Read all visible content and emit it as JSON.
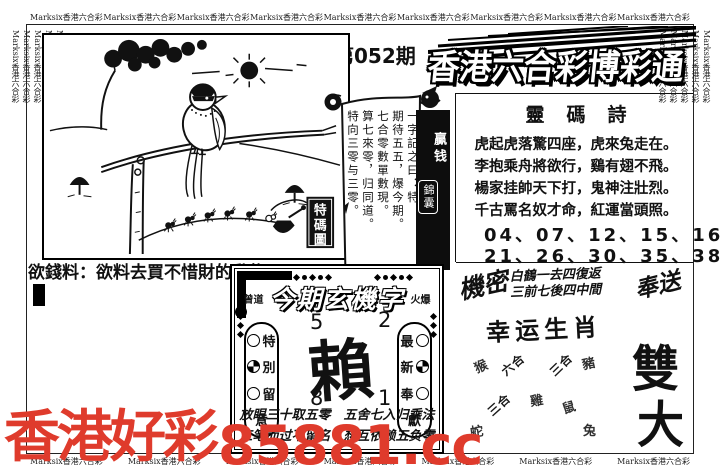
{
  "border": {
    "marquee_text": "Marksix香港六合彩"
  },
  "masthead": {
    "issue": "第052期",
    "title": "香港六合彩博彩通"
  },
  "cartoon": {
    "stamp_chars": [
      "特",
      "碼",
      "圖"
    ]
  },
  "hint": {
    "label": "欲錢料：",
    "text": "欲料去買不惜財的動物"
  },
  "scroll": {
    "text": "一字記之曰：特\n期待五五，爆今期。\n七合零數單數現。\n算七來零，归同道。\n特向三零与三零。",
    "signature": "■金小姐"
  },
  "banner": {
    "line1": "贏钱",
    "line2": "錦囊"
  },
  "poem": {
    "title": "靈碼詩",
    "lines": [
      "虎起虎落驚四座，虎來兔走在。",
      "李抱乘舟將欲行，鷄有翅不飛。",
      "楊家挂帥天下打，鬼神注壯烈。",
      "千古罵名奴才命，紅運當頭照。"
    ],
    "numbers1": "04、07、12、15、16",
    "numbers2": "21、26、30、35、38"
  },
  "secret": {
    "label": "機密",
    "line1": "白鶴一去四復返",
    "line2": "三前七後四中間",
    "gift": "奉送"
  },
  "zodiac": {
    "title": "幸运生肖",
    "items": [
      {
        "label": "猴"
      },
      {
        "label": "六合"
      },
      {
        "label": "三合"
      },
      {
        "label": "豬"
      },
      {
        "label": "三合"
      },
      {
        "label": "雞"
      },
      {
        "label": "鼠"
      },
      {
        "label": "蛇"
      },
      {
        "label": "兔"
      }
    ]
  },
  "big": {
    "char1": "雙",
    "char2": "大"
  },
  "box": {
    "tag_left": "曾道",
    "title": "今期玄機字",
    "tag_right": "火爆",
    "pill_left": [
      "特",
      "別",
      "留",
      "意"
    ],
    "pill_right": [
      "最",
      "新",
      "奉",
      "獻"
    ],
    "numbers": [
      "5",
      "2",
      "8",
      "1"
    ],
    "main_char": "賴",
    "line1": "放眼三十取五零　五舍七入归乘法",
    "line2": "三笔而过不留名　想互依赖五负零"
  },
  "watermark": {
    "cn": "香港好彩",
    "url": "85881.cc",
    "color": "#df3b2c"
  }
}
